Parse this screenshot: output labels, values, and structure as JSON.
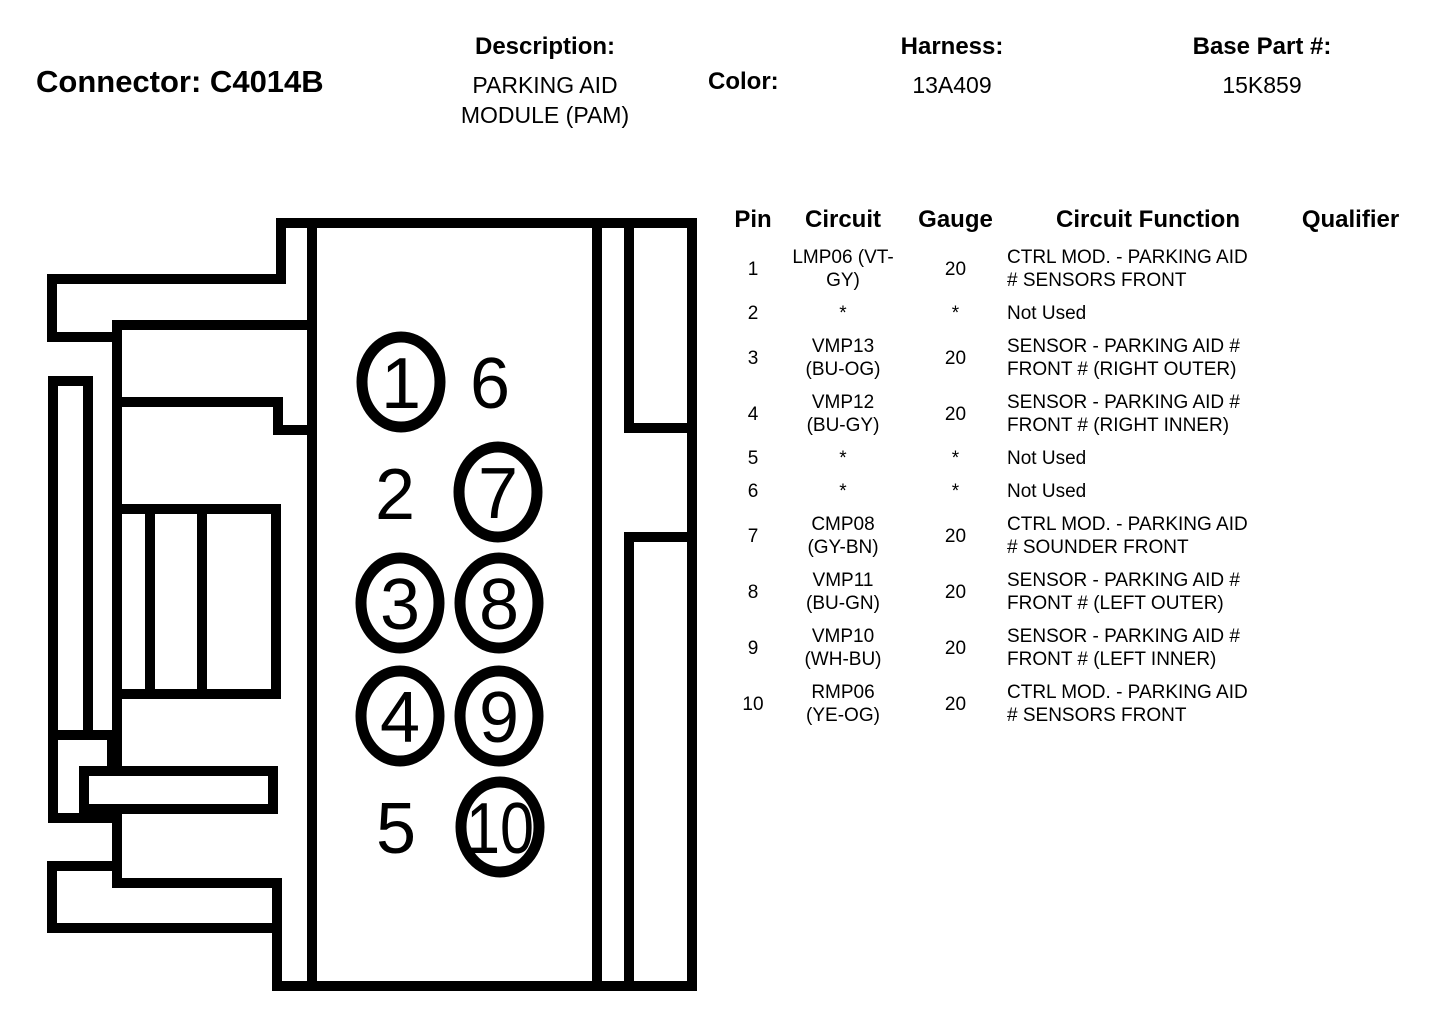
{
  "header": {
    "title": "Connector: C4014B",
    "description_label": "Description:",
    "description_value": "PARKING AID\nMODULE (PAM)",
    "color_label": "Color:",
    "color_value": "",
    "harness_label": "Harness:",
    "harness_value": "13A409",
    "base_part_label": "Base Part #:",
    "base_part_value": "15K859"
  },
  "diagram": {
    "pins": [
      {
        "label": "1",
        "circled": true
      },
      {
        "label": "2",
        "circled": false
      },
      {
        "label": "3",
        "circled": true
      },
      {
        "label": "4",
        "circled": true
      },
      {
        "label": "5",
        "circled": false
      },
      {
        "label": "6",
        "circled": false
      },
      {
        "label": "7",
        "circled": true
      },
      {
        "label": "8",
        "circled": true
      },
      {
        "label": "9",
        "circled": true
      },
      {
        "label": "10",
        "circled": true
      }
    ]
  },
  "table": {
    "headers": [
      "Pin",
      "Circuit",
      "Gauge",
      "Circuit Function",
      "Qualifier"
    ],
    "rows": [
      {
        "pin": "1",
        "circuit": "LMP06 (VT-\nGY)",
        "gauge": "20",
        "function": "CTRL MOD. - PARKING AID\n# SENSORS FRONT",
        "qualifier": ""
      },
      {
        "pin": "2",
        "circuit": "*",
        "gauge": "*",
        "function": "Not Used",
        "qualifier": ""
      },
      {
        "pin": "3",
        "circuit": "VMP13\n(BU-OG)",
        "gauge": "20",
        "function": "SENSOR - PARKING AID #\nFRONT # (RIGHT OUTER)",
        "qualifier": ""
      },
      {
        "pin": "4",
        "circuit": "VMP12\n(BU-GY)",
        "gauge": "20",
        "function": "SENSOR - PARKING AID #\nFRONT # (RIGHT INNER)",
        "qualifier": ""
      },
      {
        "pin": "5",
        "circuit": "*",
        "gauge": "*",
        "function": "Not Used",
        "qualifier": ""
      },
      {
        "pin": "6",
        "circuit": "*",
        "gauge": "*",
        "function": "Not Used",
        "qualifier": ""
      },
      {
        "pin": "7",
        "circuit": "CMP08\n(GY-BN)",
        "gauge": "20",
        "function": "CTRL MOD. - PARKING AID\n# SOUNDER FRONT",
        "qualifier": ""
      },
      {
        "pin": "8",
        "circuit": "VMP11\n(BU-GN)",
        "gauge": "20",
        "function": "SENSOR - PARKING AID #\nFRONT # (LEFT OUTER)",
        "qualifier": ""
      },
      {
        "pin": "9",
        "circuit": "VMP10\n(WH-BU)",
        "gauge": "20",
        "function": "SENSOR - PARKING AID #\nFRONT # (LEFT INNER)",
        "qualifier": ""
      },
      {
        "pin": "10",
        "circuit": "RMP06\n(YE-OG)",
        "gauge": "20",
        "function": "CTRL MOD. - PARKING AID\n# SENSORS FRONT",
        "qualifier": ""
      }
    ]
  }
}
